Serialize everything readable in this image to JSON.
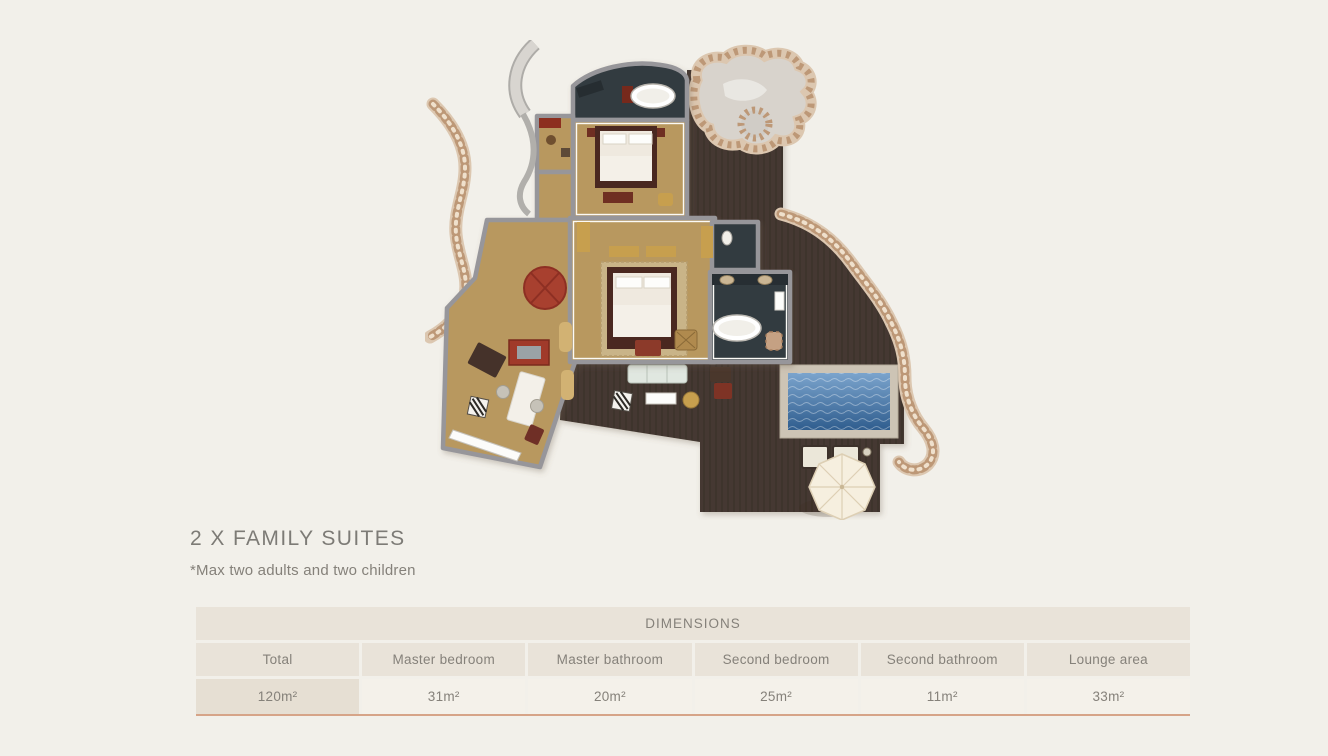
{
  "heading": {
    "title": "2 X FAMILY SUITES",
    "note": "*Max two adults and two children"
  },
  "dimensions_table": {
    "title": "DIMENSIONS",
    "columns": [
      "Total",
      "Master bedroom",
      "Master bathroom",
      "Second bedroom",
      "Second bathroom",
      "Lounge area"
    ],
    "values": [
      "120m²",
      "31m²",
      "20m²",
      "25m²",
      "11m²",
      "33m²"
    ]
  },
  "floorplan": {
    "description": "Top-down rendered floor plan of a two-bedroom family suite with entrance foyer, lounge wing, master and second bedrooms, two dark-tiled bathrooms, curved stone garden walls, outdoor timber deck, plunge pool, sun loungers and a parasol"
  },
  "colors": {
    "page-bg": "#f2f0ea",
    "title-gray": "#7d7b76",
    "text-muted": "#85817a",
    "table-beige": "#e9e3d9",
    "table-light": "#f4f1ea",
    "table-first": "#e6dfd3",
    "table-line": "#d6a488",
    "deck": "#453930",
    "floor-tan": "#b8985f",
    "room-dark": "#333b41",
    "wall-gray": "#97969a",
    "stone-base": "#dcc7b0",
    "stone-dark": "#bd9877",
    "stone-light": "#efe0cc",
    "stone-court": "#d8d3cc",
    "pool-rim": "#cdc4b5",
    "pool-top": "#7ba4cd",
    "pool-bottom": "#2f5d8e",
    "umbrella": "#f6efdf",
    "umbrella-seam": "#ddcfb4",
    "accent-red": "#8c3a2a",
    "accent-maroon": "#6f2f22",
    "accent-gold": "#c79f4e",
    "bed-frame": "#4a2820",
    "linen": "#efe9df",
    "white": "#fdfdfb"
  }
}
